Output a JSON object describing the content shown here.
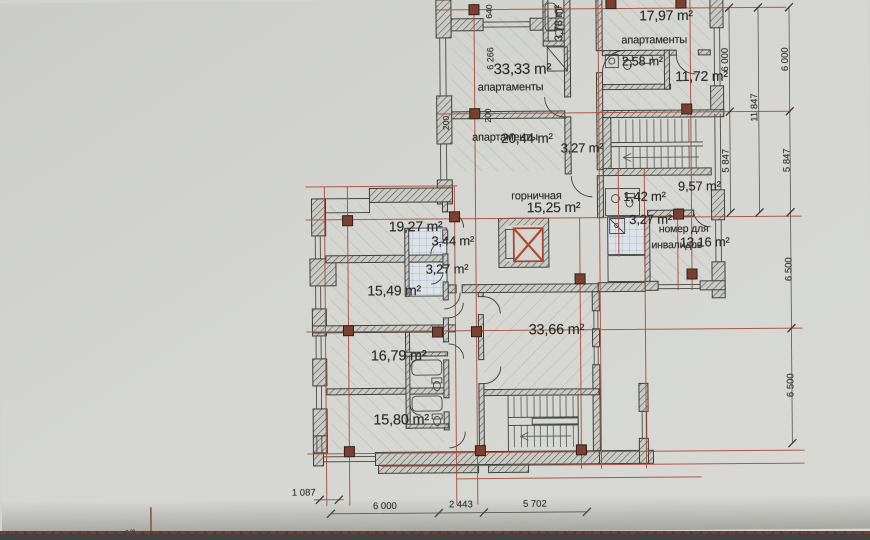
{
  "drawing": {
    "rooms": {
      "apt_1797": {
        "name": "апартаменты",
        "area": "17,97 m²"
      },
      "bath_258": {
        "area": "2,58 m²"
      },
      "room_1172": {
        "area": "11,72 m²"
      },
      "bath_378": {
        "area": "3,78 m²"
      },
      "apt_3333": {
        "name": "апартаменты",
        "area": "33,33 m²"
      },
      "apt_2044": {
        "name": "апартаменты",
        "area": "20,44 m²"
      },
      "bath_327_upper": {
        "area": "3,27 m²"
      },
      "maid": {
        "name": "горничная",
        "area": "15,25 m²"
      },
      "bath_142": {
        "area": "1,42 m²"
      },
      "room_957": {
        "area": "9,57 m²"
      },
      "bath_327_right": {
        "area": "3,27 m²"
      },
      "disabled": {
        "name_line1": "номер для",
        "name_line2": "инвалидов",
        "area": "13,16 m²"
      },
      "room_1927": {
        "area": "19,27 m²"
      },
      "bath_344": {
        "area": "3,44 m²"
      },
      "bath_327_left": {
        "area": "3,27 m²"
      },
      "room_1549": {
        "area": "15,49 m²"
      },
      "room_1679": {
        "area": "16,79 m²"
      },
      "room_1580": {
        "area": "15,80 m²"
      },
      "room_3366": {
        "area": "33,66 m²"
      }
    },
    "dimensions": {
      "right": [
        "6 000",
        "5 847",
        "11 847",
        "6 000",
        "5 847",
        "6 500",
        "6 500"
      ],
      "bottom": [
        "1 087",
        "6 000",
        "2 443",
        "5 702"
      ],
      "internal": [
        "640",
        "6 266",
        "200",
        "200"
      ],
      "axis_label": "А/6"
    },
    "colors": {
      "axis_red": "#a8493a",
      "column": "#7c4030",
      "paper": "#d3d4d0",
      "elevator_x": "#b04a33"
    }
  }
}
